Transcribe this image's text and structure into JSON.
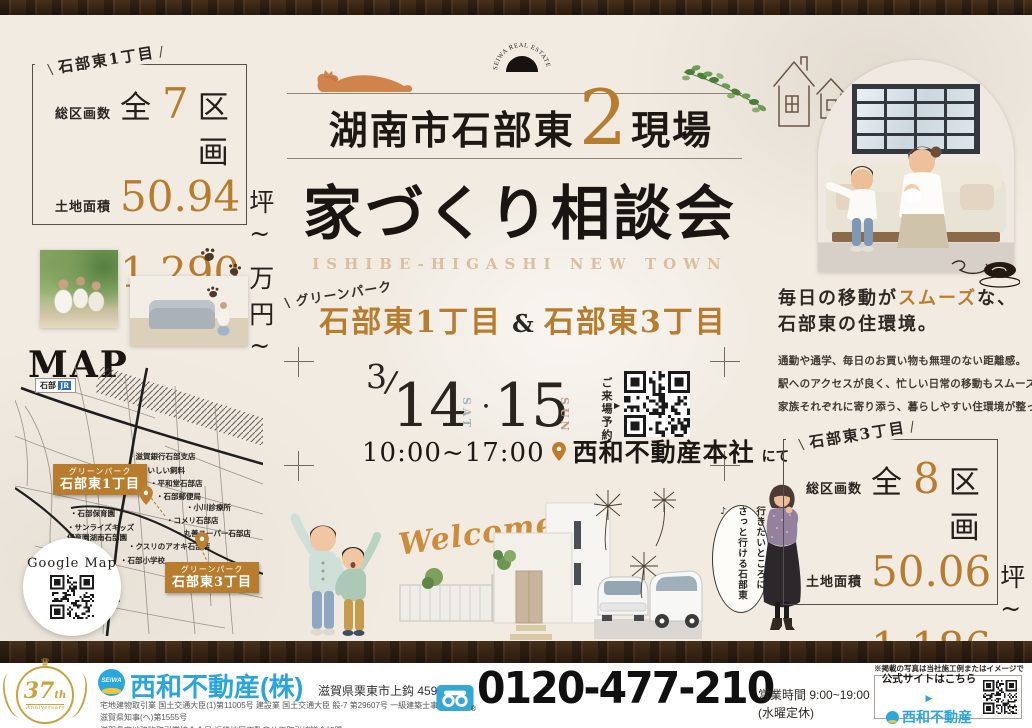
{
  "colors": {
    "accent": "#b87c2e",
    "seiwa_blue": "#2ba5dc",
    "text_dark": "#221d18",
    "subtitle_tan": "#d9bf9e",
    "sat_blue": "#9fb6bd",
    "sun_rose": "#c49a87"
  },
  "logo": {
    "arc_text": "SEIWA REAL ESTATE"
  },
  "title": {
    "pre": "湖南市石部東",
    "num": "2",
    "post": "現場",
    "main": "家づくり相談会",
    "sub": "ISHIBE-HIGASHI NEW TOWN"
  },
  "sites": {
    "park": "グリーンパーク",
    "a": "石部東1丁目",
    "amp": "&",
    "b": "石部東3丁目",
    "tick_l": "\\",
    "tick_r": "/"
  },
  "box1": {
    "label": "石部東1丁目",
    "rows": [
      {
        "name": "総区画数",
        "pre": "全",
        "num": "7",
        "post": "区画"
      },
      {
        "name": "土地面積",
        "pre": "",
        "num": "50.94",
        "post": "坪~"
      },
      {
        "name": "土地価格",
        "pre": "",
        "num": "1,290",
        "post": "万円~"
      }
    ]
  },
  "box2": {
    "label": "石部東3丁目",
    "rows": [
      {
        "name": "総区画数",
        "pre": "全",
        "num": "8",
        "post": "区画"
      },
      {
        "name": "土地面積",
        "pre": "",
        "num": "50.06",
        "post": "坪~"
      },
      {
        "name": "土地価格",
        "pre": "",
        "num": "1,186",
        "post": "万円~"
      }
    ]
  },
  "event": {
    "month": "3",
    "slash": "/",
    "day1": "14",
    "dow1": "SAT",
    "dot": "・",
    "day2": "15",
    "dow2": "SUN",
    "time": "10:00~17:00",
    "venue": "西和不動産本社",
    "venue_suffix": "にて",
    "reserve": "ご来場予約",
    "arrow": "▶"
  },
  "env": {
    "h1a": "毎日の移動が",
    "h1b": "スムーズ",
    "h1c": "な、",
    "h2": "石部東の住環境。",
    "p1": "通勤や通学、毎日のお買い物も無理のない距離感。",
    "p2": "駅へのアクセスが良く、忙しい日常の移動もスムーズ。",
    "p3": "家族それぞれに寄り添う、暮らしやすい住環境が整っています。"
  },
  "bubble": {
    "l1": "行きたいところに",
    "l2": "さっと行ける石部東♪"
  },
  "map": {
    "title": "MAP",
    "station": "石部",
    "jr": "JR",
    "google": "Google Map",
    "landmarks": [
      "滋賀銀行石部支店",
      "いしい飼料",
      "平和堂石部店",
      "石部郵便局",
      "小川診療所",
      "石部保育園",
      "サンライズキッズ\n保育園湖南石部園",
      "コメリ石部店",
      "丸善スーパー石部店",
      "クスリのアオキ石部店",
      "石部小学校"
    ],
    "pin_a": {
      "l1": "グリーンパーク",
      "l2": "石部東1丁目"
    },
    "pin_b": {
      "l1": "グリーンパーク",
      "l2": "石部東3丁目"
    }
  },
  "welcome": "Welcome!",
  "footer": {
    "anniv_num": "37",
    "anniv_th": "th",
    "anniv_word": "Anniversary",
    "crown": "♛",
    "seiwa": "SEIWA",
    "company": "西和不動産(株)",
    "address": "滋賀県栗東市上鈎 459-7",
    "license1": "宅地建物取引業 国土交通大臣(1)第11005号 建設業 国土交通大臣 般-7 第29607号 一級建築士事務所 滋賀県知事(ヘ)第1555号",
    "license2": "滋賀県宅地建物取引業協会会員 近畿地区不動産公正取引協議会加盟",
    "phone": "0120-477-210",
    "reg": "®",
    "hours": "営業時間 9:00~19:00",
    "holiday": "(水曜定休)",
    "note": "※掲載の写真は当社施工例またはイメージです。",
    "site": {
      "label": "公式サイトはこちら",
      "arrow": "▶",
      "brand": "西和不動産"
    }
  }
}
